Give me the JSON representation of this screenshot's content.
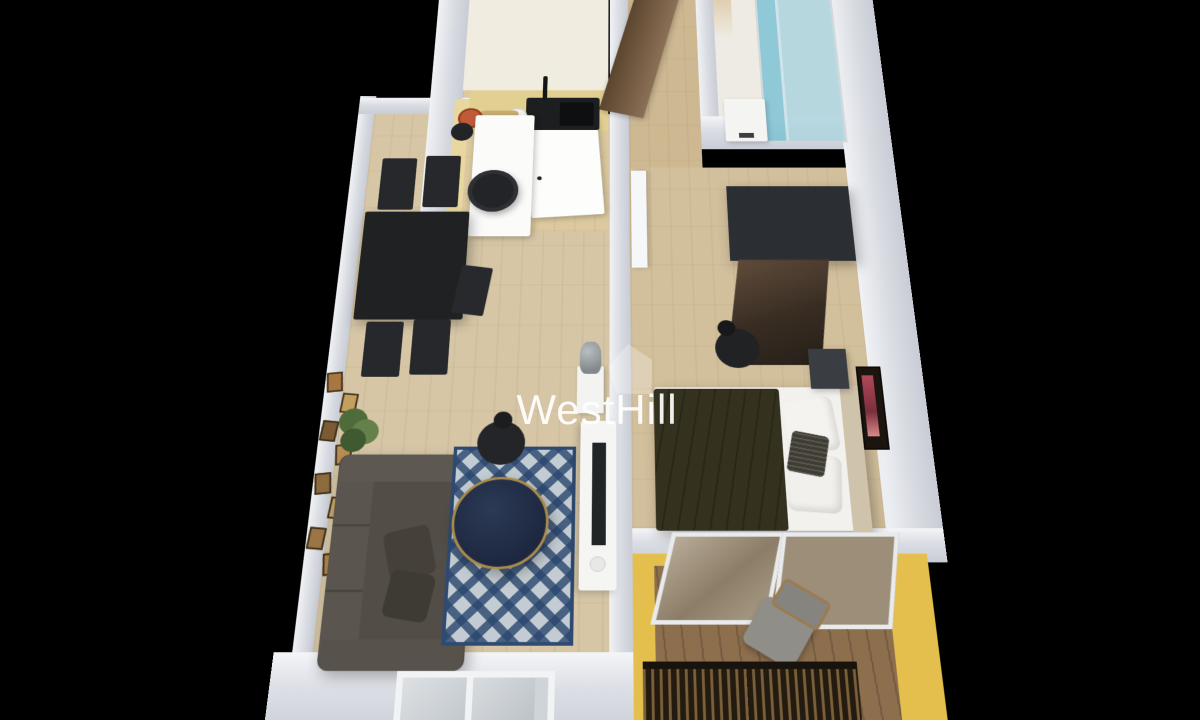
{
  "watermark": {
    "text": "WestHill",
    "logo": "house-logo-icon"
  },
  "palette": {
    "background": "#000000",
    "wall": "#d6d9de",
    "wall_face": "#f2f3f6",
    "living_floor": "#d6c6a6",
    "kitchen_floor": "#dcc99f",
    "kitchen_back_zone": "#f0ecdf",
    "counter_top": "#e2cf92",
    "hall_floor": "#cdb892",
    "bedroom_floor": "#d2bf9c",
    "bathroom_floor": "#edebe3",
    "balcony_floor": "#8d6f4e",
    "balcony_wall": "#e4bf4e",
    "kitchen_accent_wall": "#e9d7a0",
    "sofa": "#524d46",
    "rug_base": "#c3ccd2",
    "rug_pattern": "#2a466e",
    "coffee_table": "#24304b",
    "coffee_table_rim": "#a98b4a",
    "dining_set": "#1f2123",
    "bed_duvet": "#34311e",
    "bed_linen": "#f2f1ed",
    "wardrobe": "#2b2e32",
    "entry_door": "#7a5c3e",
    "shower_glass": "#aed4de",
    "railing_dark": "#241b10",
    "accent_bowl": "#c05a38",
    "watermark_color": "rgba(255,255,255,0.92)"
  },
  "scene": {
    "type": "3d-floorplan-render",
    "view": "top-down perspective, tilted toward viewer",
    "rooms": [
      {
        "name": "living-room",
        "furniture": [
          "sofa",
          "sofa-pillows",
          "area-rug",
          "coffee-table",
          "floor-lamp",
          "dining-table",
          "dining-chairs",
          "gallery-frames",
          "potted-plant",
          "tv-console",
          "tv",
          "statue",
          "window"
        ]
      },
      {
        "name": "kitchen",
        "furniture": [
          "counter",
          "sink",
          "faucet",
          "cutting-board",
          "red-bowl",
          "plates",
          "island",
          "bar-stool-large",
          "bar-stool-small",
          "interior-white-door"
        ]
      },
      {
        "name": "entry-hall",
        "furniture": [
          "wooden-entry-door"
        ]
      },
      {
        "name": "bathroom",
        "furniture": [
          "glass-shower",
          "washer-unit"
        ]
      },
      {
        "name": "bedroom",
        "furniture": [
          "wardrobe-with-mirror",
          "bed",
          "duvet",
          "pillows",
          "accent-cushion",
          "nightstand",
          "floor-lamp",
          "wall-art",
          "white-door"
        ]
      },
      {
        "name": "balcony",
        "furniture": [
          "glass-doors",
          "wooden-chair",
          "railing"
        ]
      }
    ]
  }
}
